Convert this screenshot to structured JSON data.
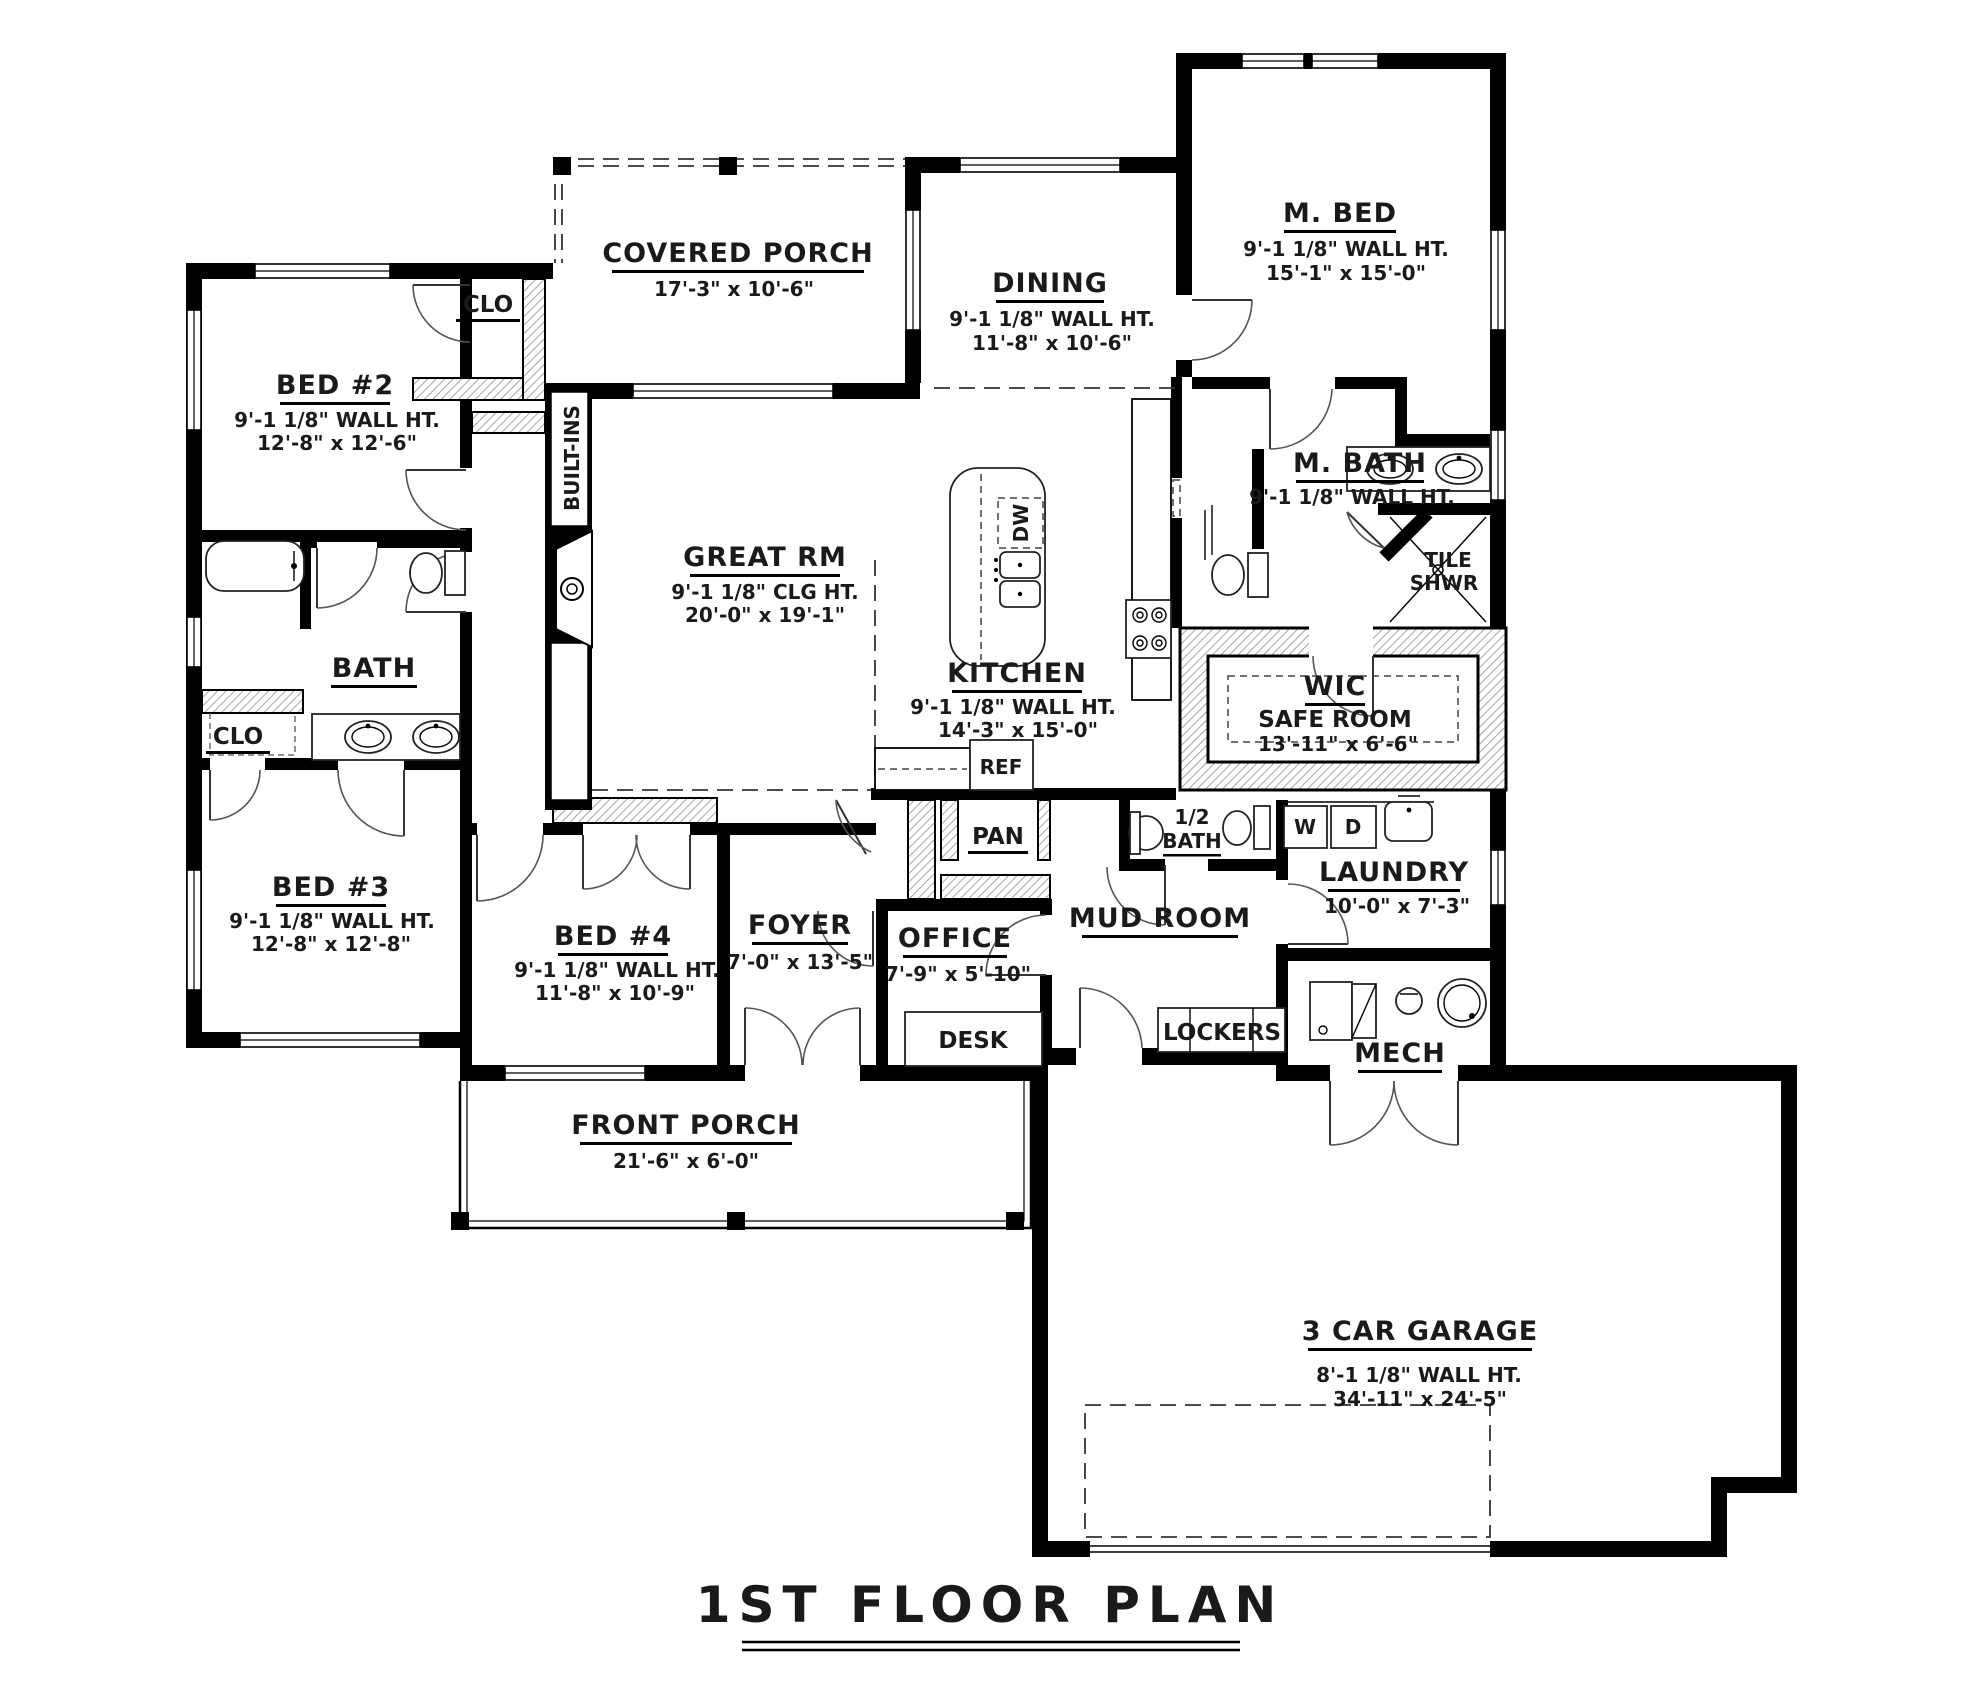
{
  "title": "1ST FLOOR PLAN",
  "rooms": {
    "covered_porch": {
      "name": "COVERED PORCH",
      "dims": "17'-3\" x 10'-6\""
    },
    "dining": {
      "name": "DINING",
      "wall": "9'-1 1/8\" WALL HT.",
      "dims": "11'-8\" x 10'-6\""
    },
    "m_bed": {
      "name": "M. BED",
      "wall": "9'-1 1/8\" WALL HT.",
      "dims": "15'-1\" x 15'-0\""
    },
    "bed2": {
      "name": "BED #2",
      "wall": "9'-1 1/8\" WALL HT.",
      "dims": "12'-8\" x 12'-6\""
    },
    "bed3": {
      "name": "BED #3",
      "wall": "9'-1 1/8\" WALL HT.",
      "dims": "12'-8\" x 12'-8\""
    },
    "bed4": {
      "name": "BED #4",
      "wall": "9'-1 1/8\" WALL HT.",
      "dims": "11'-8\" x 10'-9\""
    },
    "great_rm": {
      "name": "GREAT RM",
      "wall": "9'-1 1/8\" CLG HT.",
      "dims": "20'-0\" x 19'-1\""
    },
    "kitchen": {
      "name": "KITCHEN",
      "wall": "9'-1 1/8\" WALL HT.",
      "dims": "14'-3\" x 15'-0\""
    },
    "m_bath": {
      "name": "M. BATH",
      "wall": "9'-1 1/8\" WALL HT."
    },
    "tile_shwr": {
      "line1": "TILE",
      "line2": "SHWR"
    },
    "wic": {
      "name": "WIC",
      "name2": "SAFE ROOM",
      "dims": "13'-11\" x 6'-6\""
    },
    "bath": {
      "name": "BATH"
    },
    "clo_top": {
      "name": "CLO"
    },
    "clo_left": {
      "name": "CLO"
    },
    "built_ins": {
      "name": "BUILT-INS"
    },
    "foyer": {
      "name": "FOYER",
      "dims": "7'-0\" x 13'-5\""
    },
    "office": {
      "name": "OFFICE",
      "dims": "7'-9\" x 5'-10\""
    },
    "desk": {
      "name": "DESK"
    },
    "pan": {
      "name": "PAN"
    },
    "ref": {
      "name": "REF"
    },
    "dw": {
      "name": "DW"
    },
    "half_bath": {
      "line1": "1/2",
      "line2": "BATH"
    },
    "mud_room": {
      "name": "MUD ROOM"
    },
    "laundry": {
      "name": "LAUNDRY",
      "dims": "10'-0\" x 7'-3\""
    },
    "washer": {
      "name": "W"
    },
    "dryer": {
      "name": "D"
    },
    "lockers": {
      "name": "LOCKERS"
    },
    "mech": {
      "name": "MECH"
    },
    "front_porch": {
      "name": "FRONT PORCH",
      "dims": "21'-6\" x 6'-0\""
    },
    "garage": {
      "name": "3 CAR GARAGE",
      "wall": "8'-1 1/8\" WALL HT.",
      "dims": "34'-11\" x 24'-5\""
    }
  }
}
